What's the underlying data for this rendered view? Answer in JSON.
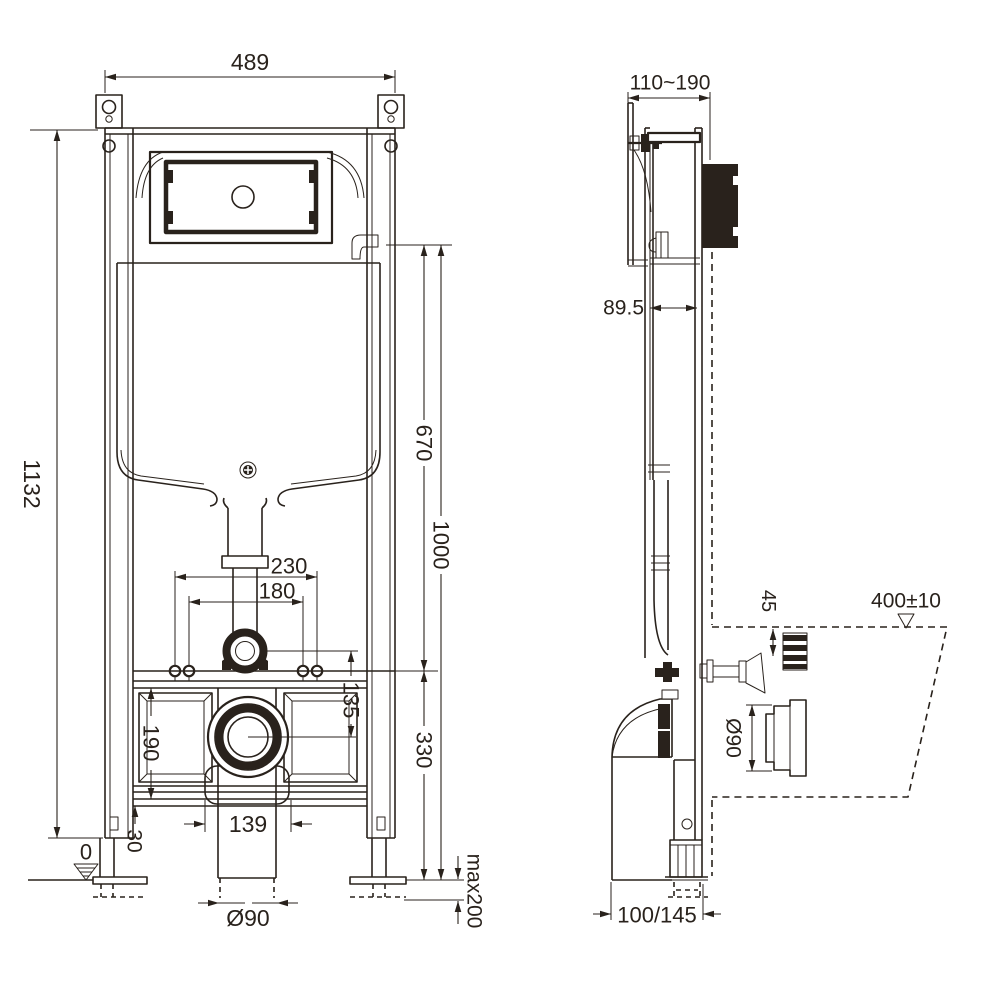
{
  "front_view": {
    "width": "489",
    "height": "1132",
    "flush_bend_center": "670",
    "cistern_ref": "1000",
    "fixing_width_outer": "230",
    "fixing_width_inner": "180",
    "bend_to_outlet": "135",
    "panel_opening": "190",
    "outlet_center": "330",
    "base_offset": "30",
    "socket_width": "139",
    "outlet_dia": "Ø90",
    "floor_level": "0",
    "leg_extension": "max200"
  },
  "side_view": {
    "depth_range": "110~190",
    "frame_depth": "89.5",
    "flush_offset": "45",
    "pan_outline_height": "400±10",
    "outlet_dia": "Ø90",
    "bend_depth": "100/145"
  },
  "colors": {
    "line": "#29221c",
    "background": "#ffffff"
  }
}
